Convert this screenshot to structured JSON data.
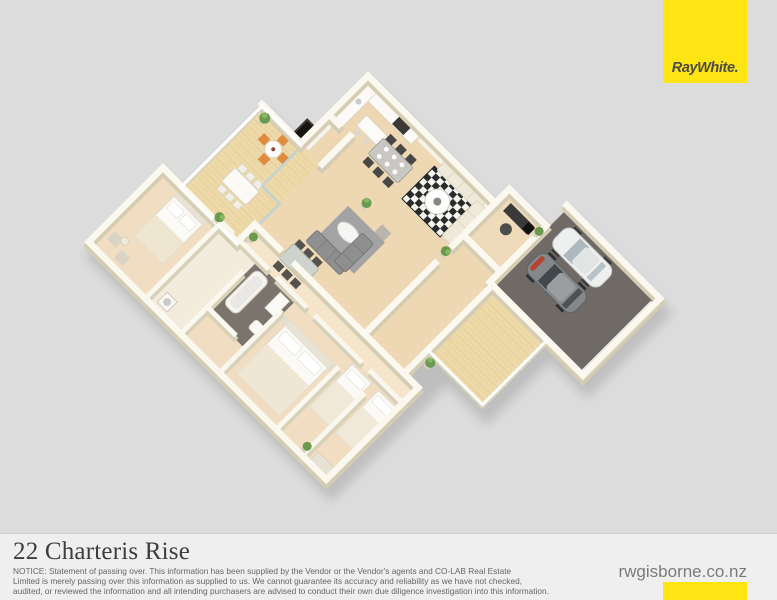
{
  "brand": {
    "logo_text": "RayWhite.",
    "website": "rwgisborne.co.nz",
    "colors": {
      "brand_yellow": "#FFE414",
      "logo_text_color": "#4E4A47"
    }
  },
  "listing": {
    "address": "22 Charteris Rise"
  },
  "footer": {
    "notice_lines": [
      "NOTICE: Statement of passing over. This information has been supplied by the Vendor or the Vendor's agents and CO-LAB Real Estate",
      "Limited is merely passing over this information as supplied to us. We cannot guarantee its accuracy and reliability as we have not checked,",
      "audited, or reviewed the information and all intending purchasers are advised to conduct their own due diligence investigation into this information."
    ]
  },
  "page": {
    "background": "#dcdcdc",
    "footer_background": "#efefef"
  },
  "floorplan": {
    "description": "3D isometric (dollhouse) floor plan render of a single-storey home, rotated 45 degrees",
    "rooms": [
      "deck",
      "kitchen",
      "pantry",
      "dining",
      "lounge",
      "family-room",
      "entry-hall",
      "office",
      "garage",
      "rear-deck",
      "hallway",
      "bedroom-1",
      "bathroom",
      "laundry",
      "master-bedroom",
      "bedroom-2",
      "bedroom-3"
    ],
    "vehicles": [
      "white-car",
      "grey-car"
    ],
    "furniture": [
      "outdoor-table-orange-chairs",
      "outdoor-dining-table",
      "kitchen-island",
      "dining-table-dark-chairs",
      "cream-corner-sofa",
      "checkered-rug",
      "round-coffee-table",
      "grey-corner-sofa",
      "grey-rug",
      "oval-coffee-table",
      "glass-dining-table",
      "office-desk",
      "double-bed",
      "double-bed",
      "single-bed",
      "single-bed",
      "bathtub",
      "potted-plants"
    ],
    "colors": {
      "floor_wood": "#eed8b4",
      "deck_wood": "#eed9a9",
      "wall_top": "#fbf8ef",
      "wall_side": "#d5cdb3",
      "garage_floor": "#6f6a66",
      "rug_grey": "#a3a3a3",
      "rug_checker_dark": "#2b2b2b",
      "chair_orange": "#df8c3e",
      "chair_dark": "#4a4846",
      "plant_green": "#6a9a4d"
    }
  }
}
